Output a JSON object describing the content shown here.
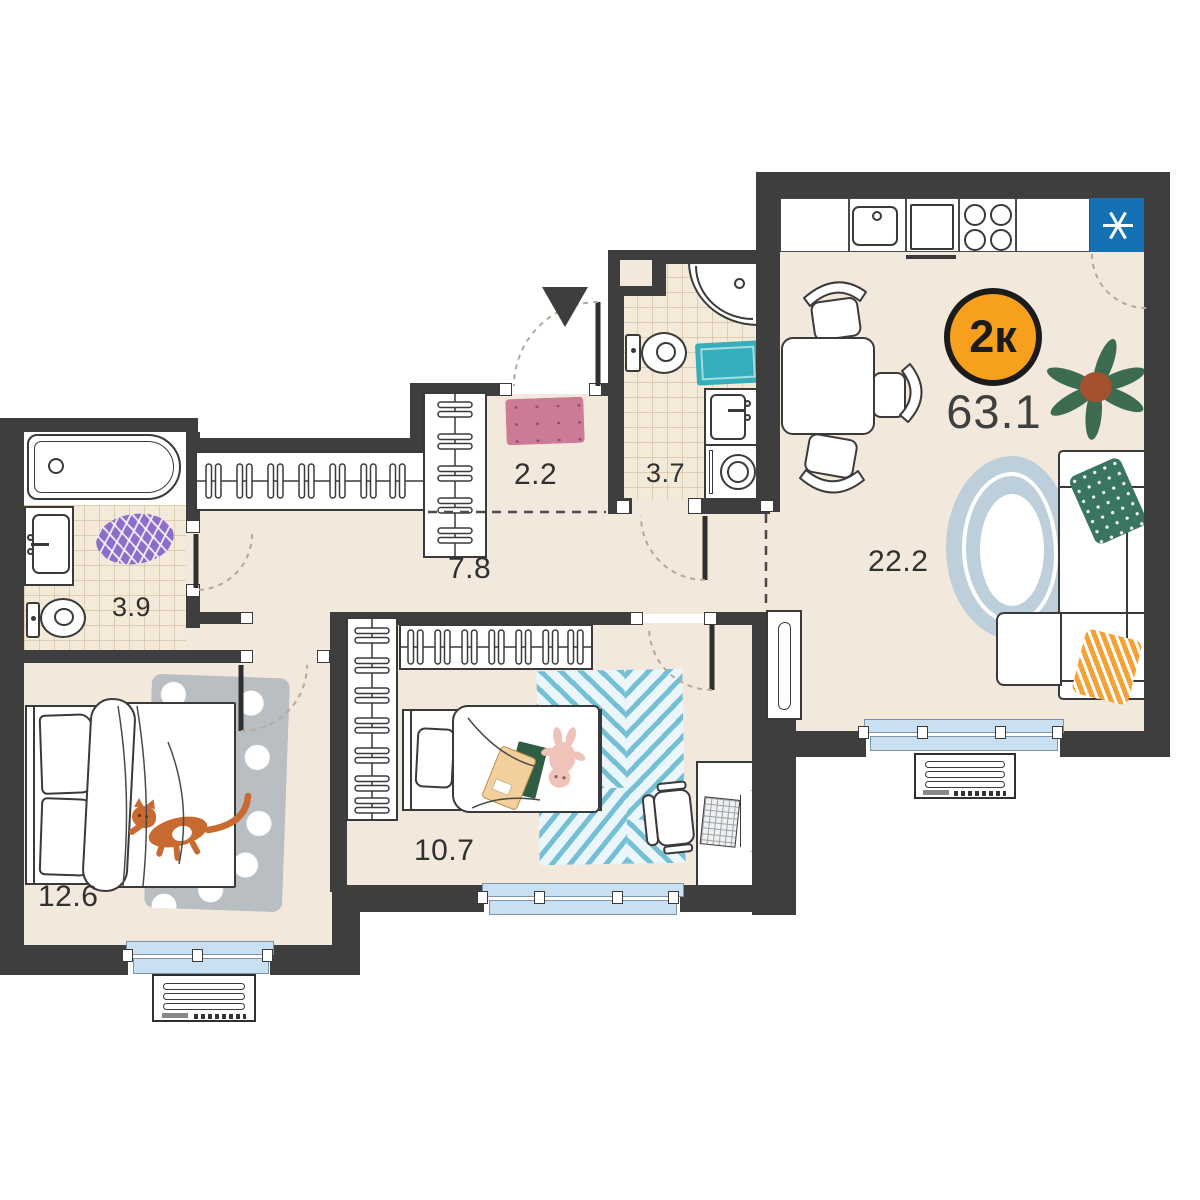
{
  "plan": {
    "badge": {
      "label": "2к"
    },
    "total_area": "63.1",
    "rooms": [
      {
        "name": "living-kitchen",
        "area": "22.2"
      },
      {
        "name": "hallway",
        "area": "7.8"
      },
      {
        "name": "entry",
        "area": "2.2"
      },
      {
        "name": "bathroom",
        "area": "3.7"
      },
      {
        "name": "bathroom-second",
        "area": "3.9"
      },
      {
        "name": "bedroom",
        "area": "12.6"
      },
      {
        "name": "bedroom-second",
        "area": "10.7"
      }
    ],
    "icons": {
      "fridge": "six-spoke-asterisk",
      "entrance": "down-triangle-arrow"
    },
    "colors": {
      "wall": "#3E3E3E",
      "floor": "#F2E8DC",
      "window": "#C9DFF2",
      "badge": "#F6A01D",
      "fridge": "#1471B4",
      "teal_mat": "#35AEBB",
      "purple_mat": "#8E6CC9",
      "pink_mat": "#CC7A95",
      "green_pillow": "#3A7561",
      "orange_pillow": "#F4A136",
      "living_rug": "#BCCFDA",
      "bedroom_rug": "#B9BEC3",
      "stripe_rug": "#74BFD6",
      "cat": "#C96A31",
      "plant_leaf": "#3D6B50"
    }
  }
}
